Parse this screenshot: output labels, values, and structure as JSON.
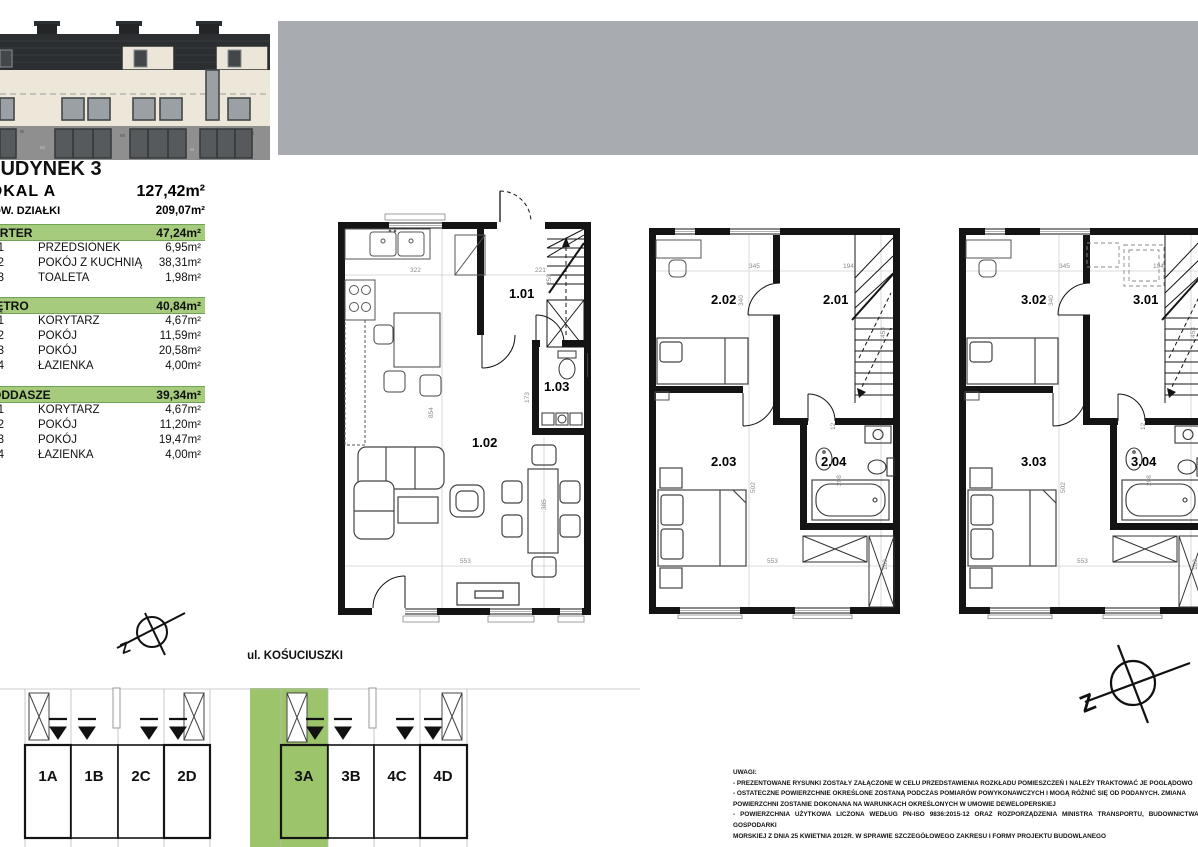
{
  "panel": {
    "building_title": "BUDYNEK 3",
    "unit_label": "LOKAL A",
    "unit_area": "127,42m²",
    "plot_label": "POW. DZIAŁKI",
    "plot_area": "209,07m²",
    "sections": [
      {
        "name": "PARTER",
        "area": "47,24m²",
        "rows": [
          {
            "id": "1.01",
            "label": "PRZEDSIONEK",
            "area": "6,95m²"
          },
          {
            "id": "1.02",
            "label": "POKÓJ Z KUCHNIĄ",
            "area": "38,31m²"
          },
          {
            "id": "1.03",
            "label": "TOALETA",
            "area": "1,98m²"
          }
        ]
      },
      {
        "name": "PIĘTRO",
        "area": "40,84m²",
        "rows": [
          {
            "id": "2.01",
            "label": "KORYTARZ",
            "area": "4,67m²"
          },
          {
            "id": "2.02",
            "label": "POKÓJ",
            "area": "11,59m²"
          },
          {
            "id": "2.03",
            "label": "POKÓJ",
            "area": "20,58m²"
          },
          {
            "id": "2.04",
            "label": "ŁAZIENKA",
            "area": "4,00m²"
          }
        ]
      },
      {
        "name": "PODDASZE",
        "area": "39,34m²",
        "rows": [
          {
            "id": "3.01",
            "label": "KORYTARZ",
            "area": "4,67m²"
          },
          {
            "id": "3.02",
            "label": "POKÓJ",
            "area": "11,20m²"
          },
          {
            "id": "3.03",
            "label": "POKÓJ",
            "area": "19,47m²"
          },
          {
            "id": "3.04",
            "label": "ŁAZIENKA",
            "area": "4,00m²"
          }
        ]
      }
    ]
  },
  "plans": [
    {
      "rooms": [
        "1.01",
        "1.02",
        "1.03"
      ],
      "dims": [
        "322",
        "221",
        "250",
        "854",
        "553",
        "385",
        "173"
      ]
    },
    {
      "rooms": [
        "2.02",
        "2.01",
        "2.03",
        "2.04"
      ],
      "dims": [
        "345",
        "194",
        "340",
        "453",
        "502",
        "553",
        "169",
        "208",
        "12"
      ]
    },
    {
      "rooms": [
        "3.02",
        "3.01",
        "3.03",
        "3.04"
      ],
      "dims": [
        "345",
        "194",
        "340",
        "453",
        "502",
        "553",
        "169",
        "208",
        "12"
      ]
    }
  ],
  "site": {
    "street": "ul. KOŚUCIUSZKI",
    "north_letter": "Z",
    "units": [
      "1A",
      "1B",
      "2C",
      "2D",
      "3A",
      "3B",
      "4C",
      "4D"
    ],
    "highlighted_unit": "3A"
  },
  "notes": {
    "title": "UWAGI:",
    "lines": [
      "- PREZENTOWANE RYSUNKI ZOSTAŁY ZAŁĄCZONE W CELU PRZEDSTAWIENIA ROZKŁADU POMIESZCZEŃ I NALEŻY TRAKTOWAĆ JE POGLĄDOWO",
      "- OSTATECZNE POWIERZCHNIE OKREŚLONE ZOSTANĄ PODCZAS POMIARÓW POWYKONAWCZYCH I MOGĄ RÓŻNIĆ SIĘ OD PODANYCH. ZMIANA",
      "POWIERZCHNI ZOSTANIE DOKONANA NA WARUNKACH OKREŚLONYCH W UMOWIE DEWELOPERSKIEJ",
      "- POWIERZCHNIA UŻYTKOWA LICZONA WEDŁUG PN-ISO 9836:2015-12 ORAZ ROZPORZĄDZENIA MINISTRA TRANSPORTU, BUDOWNICTWA I",
      "GOSPODARKI",
      "MORSKIEJ Z DNIA 25 KWIETNIA 2012R. W SPRAWIE SZCZEGÓŁOWEGO ZAKRESU I FORMY PROJEKTU BUDOWLANEGO"
    ]
  },
  "colors": {
    "accent_green": "#a6cb7d",
    "site_green": "#9cc46b",
    "gray_band": "#a8abaf"
  }
}
